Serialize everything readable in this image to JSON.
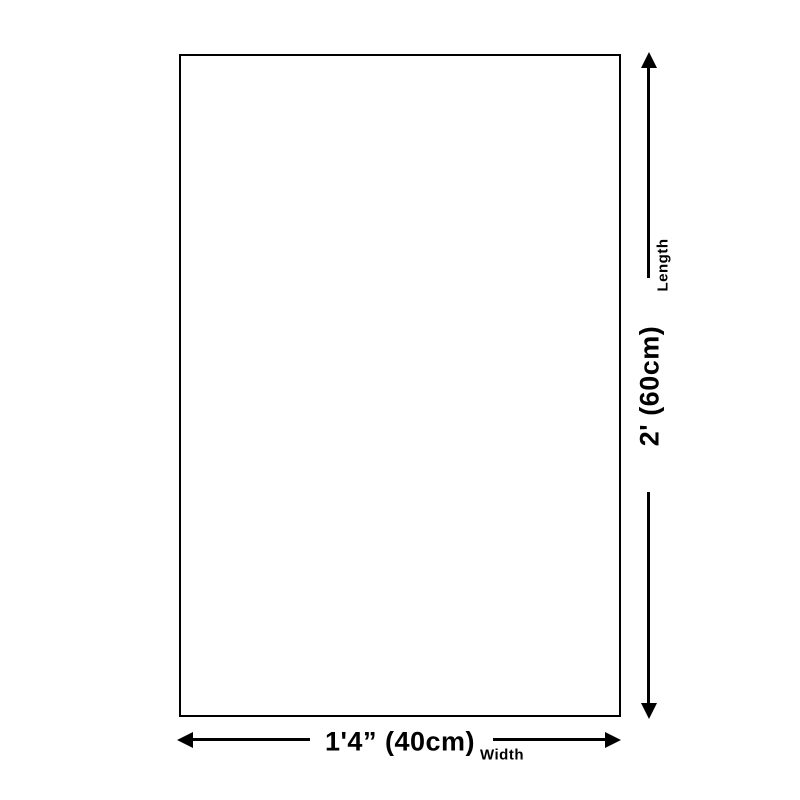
{
  "diagram": {
    "type": "product-dimension-diagram",
    "colors": {
      "background": "#ffffff",
      "line": "#000000",
      "text": "#000000"
    },
    "length_dimension": {
      "value": "2' (60cm)",
      "label": "Length"
    },
    "width_dimension": {
      "value": "1'4” (40cm)",
      "label": "Width"
    }
  }
}
